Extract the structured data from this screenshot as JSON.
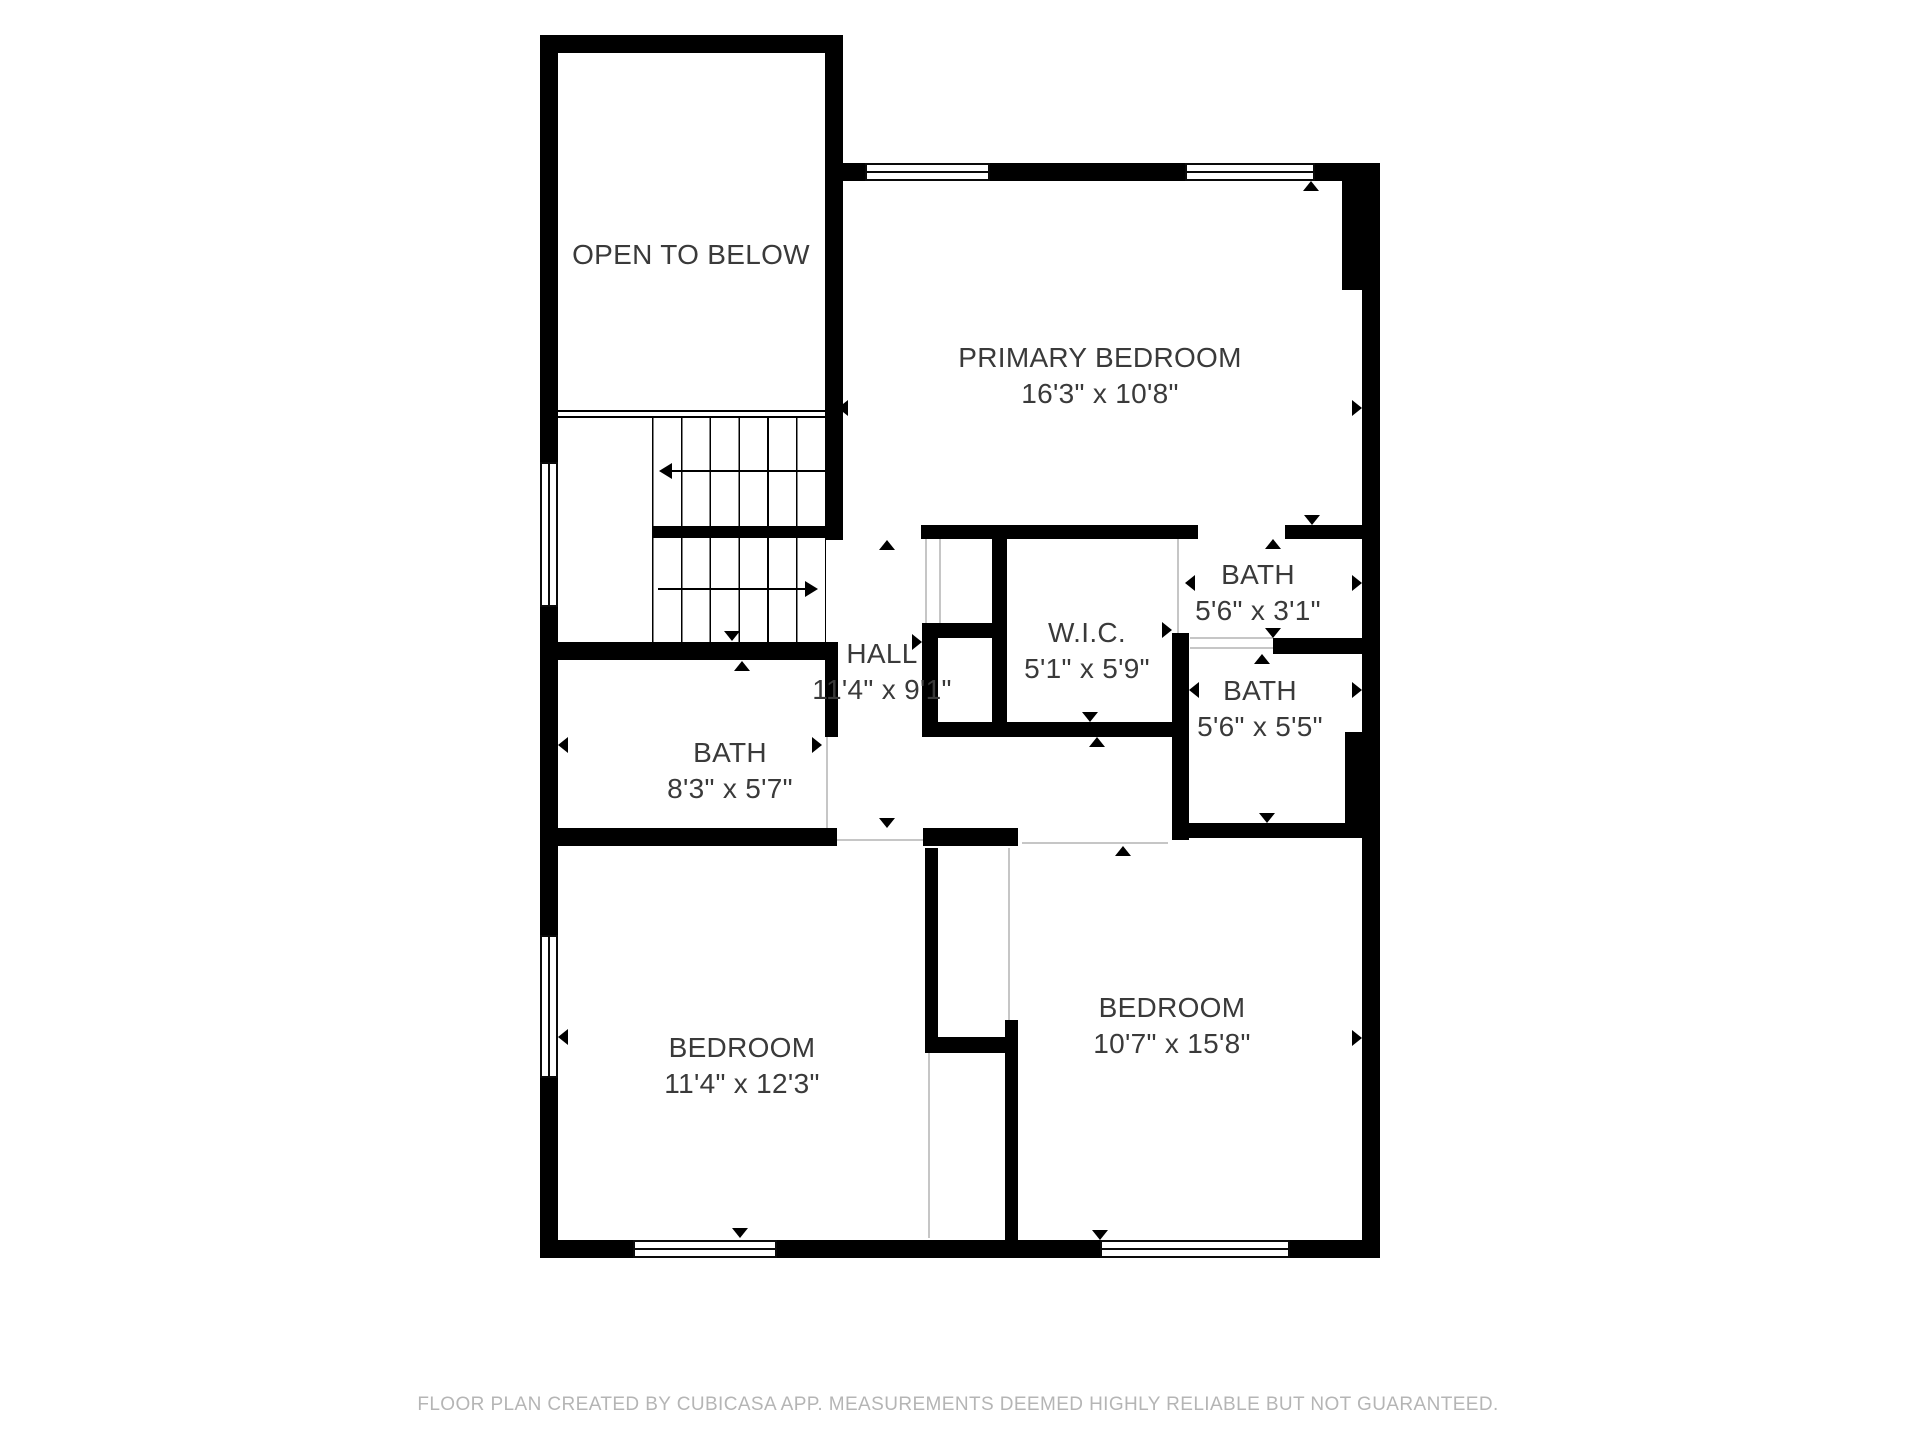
{
  "rooms": {
    "open_below": {
      "name": "OPEN TO BELOW",
      "dims": ""
    },
    "primary": {
      "name": "PRIMARY BEDROOM",
      "dims": "16'3\" x 10'8\""
    },
    "bath_top": {
      "name": "BATH",
      "dims": "5'6\" x 3'1\""
    },
    "wic": {
      "name": "W.I.C.",
      "dims": "5'1\" x 5'9\""
    },
    "bath_mid": {
      "name": "BATH",
      "dims": "5'6\" x 5'5\""
    },
    "hall": {
      "name": "HALL",
      "dims": "11'4\" x 9'1\""
    },
    "bath_left": {
      "name": "BATH",
      "dims": "8'3\" x 5'7\""
    },
    "bedroom_left": {
      "name": "BEDROOM",
      "dims": "11'4\" x 12'3\""
    },
    "bedroom_right": {
      "name": "BEDROOM",
      "dims": "10'7\" x 15'8\""
    }
  },
  "footer": {
    "text": "FLOOR PLAN CREATED BY CUBICASA APP. MEASUREMENTS DEEMED HIGHLY RELIABLE BUT NOT GUARANTEED."
  },
  "colors": {
    "walls": "#000000",
    "labels": "#3a3a3a",
    "footer_text": "#b5b5b5",
    "door_leaf": "#c6c6c6",
    "background": "#ffffff"
  }
}
